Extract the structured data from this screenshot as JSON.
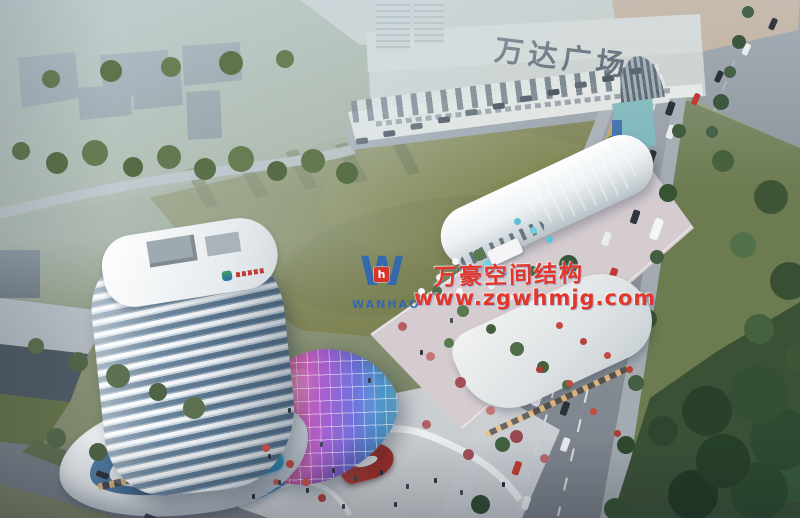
{
  "signs": {
    "wanda_plaza": "万达广场"
  },
  "watermark": {
    "logo_initial": "W",
    "logo_badge": "h",
    "logo_text": "WANHAO",
    "company_cn": "万豪空间结构",
    "website": "www.zgwhmjg.com"
  },
  "palette": {
    "watermark_red": "#e3372a",
    "watermark_blue": "#2c66b4",
    "field_green": "#7c814f",
    "park_green": "#2e4630",
    "road_gray": "#878d96",
    "tower_glass_blue": "#5a768f",
    "accent_red": "#c0392b",
    "haze": "#cfdce6",
    "canopy_gradient": [
      "#ede469",
      "#f0a844",
      "#e2679c",
      "#a85ecf",
      "#6f74dd",
      "#55aade",
      "#93dcea"
    ]
  }
}
